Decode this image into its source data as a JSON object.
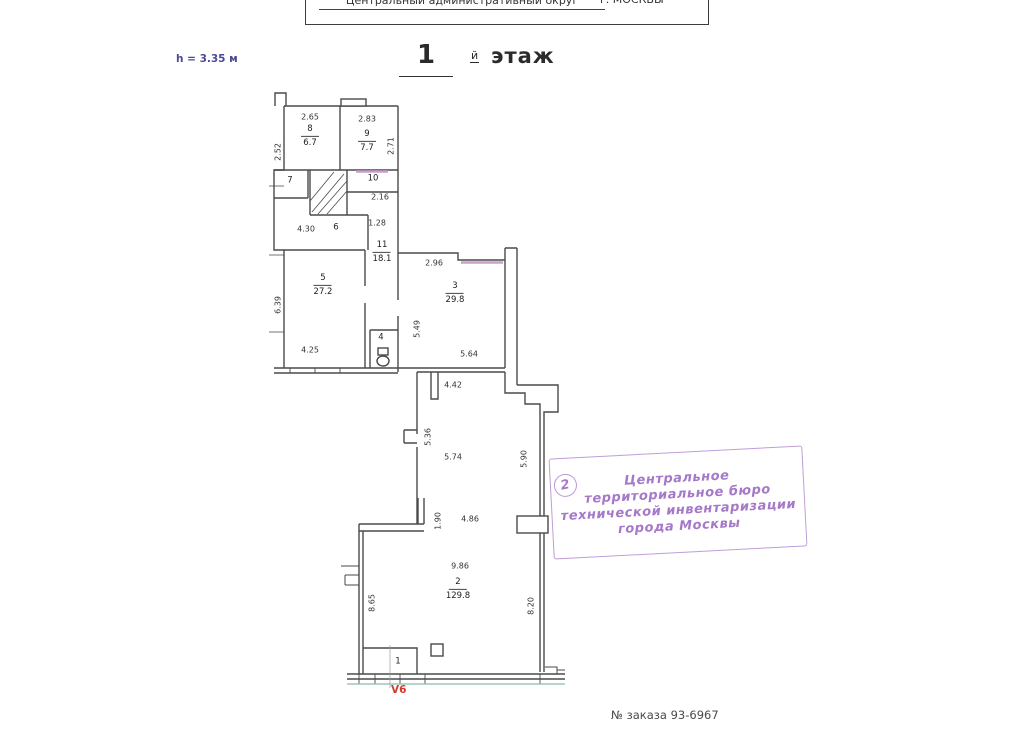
{
  "header": {
    "district": "Центральный административный округ",
    "city": "г. МОСКВЫ"
  },
  "title": {
    "height_label": "h = 3.35 м",
    "floor_number": "1",
    "floor_suffix": "й",
    "floor_word": "этаж"
  },
  "plan": {
    "rooms": [
      {
        "num": "8",
        "area": "6.7",
        "x": 310,
        "y": 136
      },
      {
        "num": "9",
        "area": "7.7",
        "x": 367,
        "y": 141
      },
      {
        "num": "7",
        "area": "",
        "x": 290,
        "y": 181
      },
      {
        "num": "10",
        "area": "",
        "x": 373,
        "y": 179
      },
      {
        "num": "6",
        "area": "",
        "x": 336,
        "y": 228
      },
      {
        "num": "11",
        "area": "18.1",
        "x": 382,
        "y": 252
      },
      {
        "num": "5",
        "area": "27.2",
        "x": 323,
        "y": 285
      },
      {
        "num": "4",
        "area": "",
        "x": 381,
        "y": 338
      },
      {
        "num": "3",
        "area": "29.8",
        "x": 455,
        "y": 293
      },
      {
        "num": "2",
        "area": "129.8",
        "x": 458,
        "y": 589
      },
      {
        "num": "1",
        "area": "",
        "x": 398,
        "y": 662
      }
    ],
    "dimensions": [
      {
        "t": "2.65",
        "x": 310,
        "y": 117,
        "r": 0
      },
      {
        "t": "2.52",
        "x": 278,
        "y": 152,
        "r": 1
      },
      {
        "t": "2.83",
        "x": 367,
        "y": 119,
        "r": 0
      },
      {
        "t": "2.71",
        "x": 391,
        "y": 146,
        "r": 1
      },
      {
        "t": "2.16",
        "x": 380,
        "y": 197,
        "r": 0
      },
      {
        "t": "4.30",
        "x": 306,
        "y": 229,
        "r": 0
      },
      {
        "t": "1.28",
        "x": 377,
        "y": 223,
        "r": 0
      },
      {
        "t": "6.39",
        "x": 278,
        "y": 305,
        "r": 1
      },
      {
        "t": "4.25",
        "x": 310,
        "y": 350,
        "r": 0
      },
      {
        "t": "2.96",
        "x": 434,
        "y": 263,
        "r": 0
      },
      {
        "t": "5.49",
        "x": 417,
        "y": 329,
        "r": 1
      },
      {
        "t": "5.64",
        "x": 469,
        "y": 354,
        "r": 0
      },
      {
        "t": "4.42",
        "x": 453,
        "y": 385,
        "r": 0
      },
      {
        "t": "5.36",
        "x": 428,
        "y": 437,
        "r": 1
      },
      {
        "t": "5.74",
        "x": 453,
        "y": 457,
        "r": 0
      },
      {
        "t": "5.90",
        "x": 524,
        "y": 459,
        "r": 1
      },
      {
        "t": "1.90",
        "x": 438,
        "y": 521,
        "r": 1
      },
      {
        "t": "4.86",
        "x": 470,
        "y": 519,
        "r": 0
      },
      {
        "t": "9.86",
        "x": 460,
        "y": 566,
        "r": 0
      },
      {
        "t": "8.65",
        "x": 372,
        "y": 603,
        "r": 1
      },
      {
        "t": "8.20",
        "x": 531,
        "y": 606,
        "r": 1
      }
    ],
    "basement_mark": "V6"
  },
  "stamp": {
    "number": "2",
    "lines": [
      "Центральное",
      "территориальное бюро",
      "технической инвентаризации",
      "города Москвы"
    ]
  },
  "footer": {
    "order_number": "№ заказа 93-6967"
  },
  "colors": {
    "wall": "#4a4a4a",
    "window_pink": "#c9a0c9",
    "bottom_teal": "#8fb8ab",
    "stamp_purple": "#a578c8",
    "mark_red": "#d23b2e",
    "height_note_blue": "#4a4a99"
  }
}
